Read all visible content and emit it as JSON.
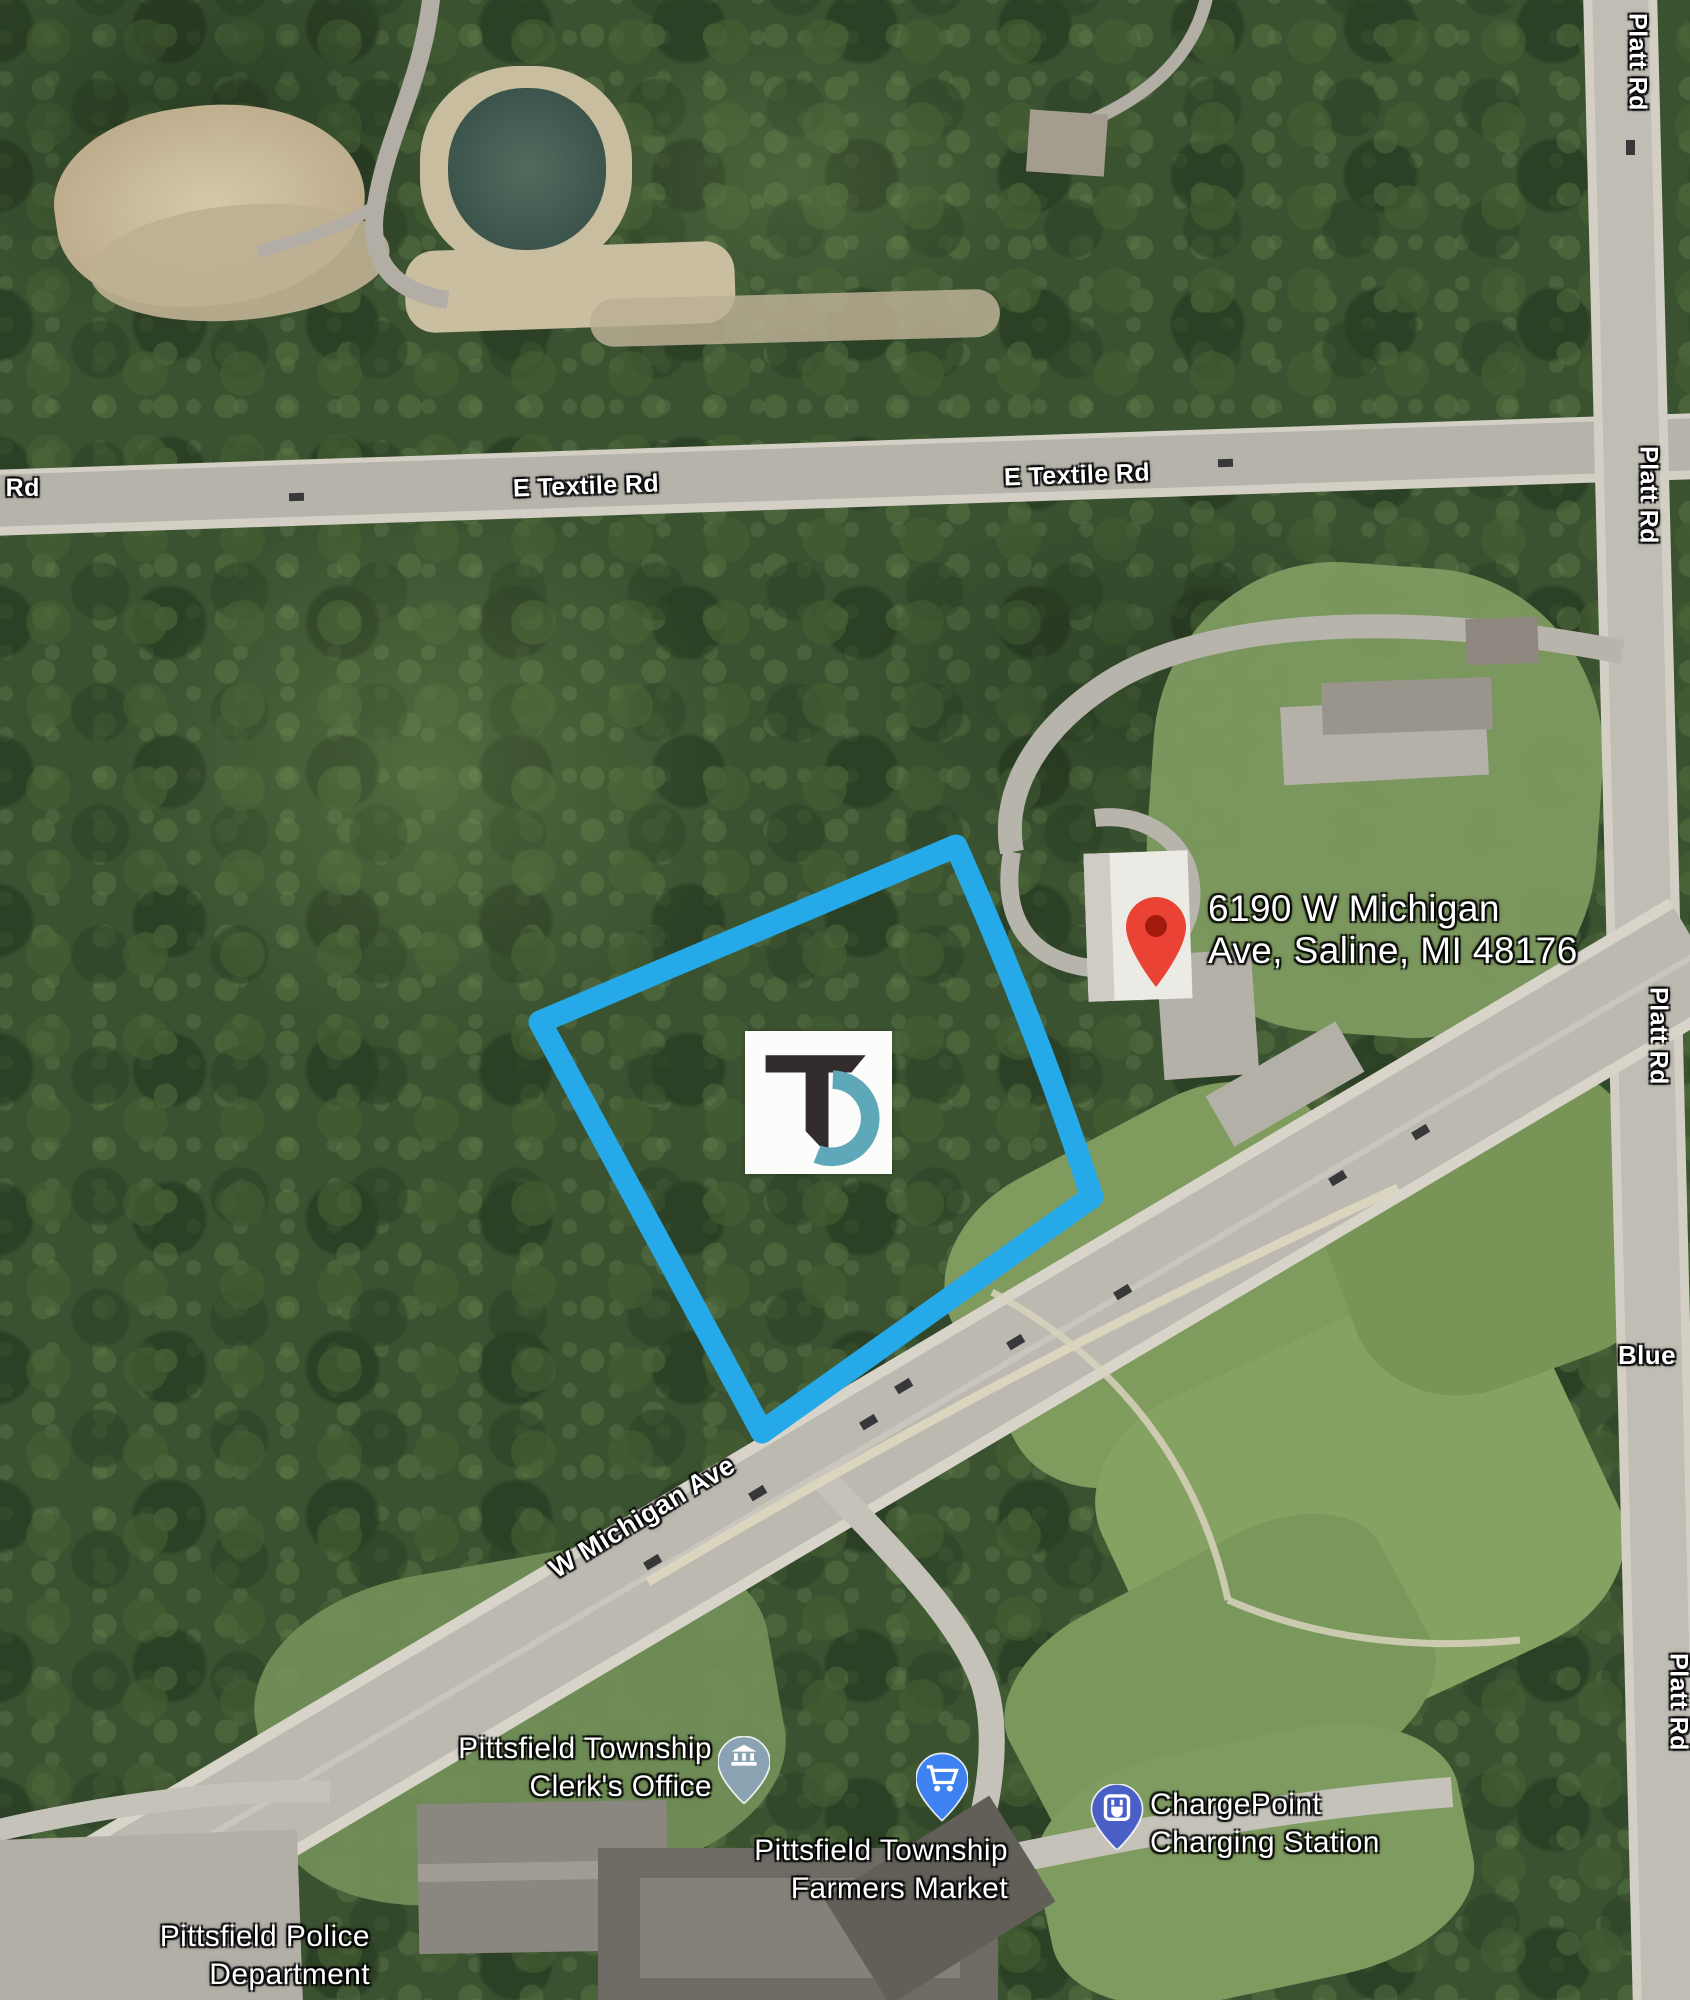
{
  "map_labels": {
    "road_e_textile": "E Textile Rd",
    "road_platt": "Platt Rd",
    "road_w_michigan": "W Michigan Ave",
    "road_blue_partial": "Blue",
    "road_left_partial": "e Rd"
  },
  "marker": {
    "address_line1": "6190 W Michigan",
    "address_line2": "Ave, Saline, MI 48176",
    "pin_color": "#ea4335",
    "pin_hole_color": "#a31b0d"
  },
  "pois": {
    "clerk": {
      "line1": "Pittsfield Township",
      "line2": "Clerk's Office",
      "pin_color": "#8aa2b2"
    },
    "farmers_market": {
      "line1": "Pittsfield Township",
      "line2": "Farmers Market",
      "pin_color": "#3e82f1"
    },
    "chargepoint": {
      "line1": "ChargePoint",
      "line2": "Charging Station",
      "pin_color": "#4a5fc6"
    },
    "police": {
      "line1": "Pittsfield Police",
      "line2": "Department"
    }
  },
  "parcel": {
    "outline_color": "#25a9e8"
  },
  "logo": {
    "monogram": "TD",
    "dark_color": "#332c2d",
    "teal_color": "#5fa8ba"
  }
}
